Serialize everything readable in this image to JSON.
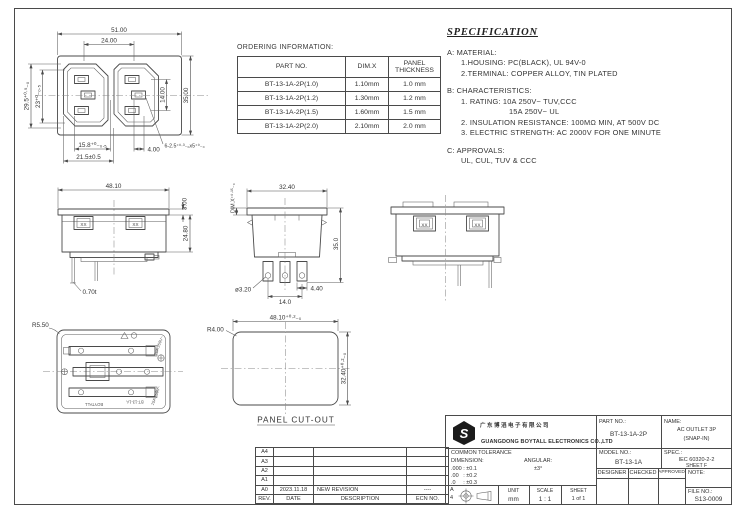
{
  "ordering": {
    "title": "ORDERING INFORMATION:",
    "col1": "PART NO.",
    "col2": "DIM.X",
    "col3": "PANEL\nTHICKNESS",
    "rows": [
      [
        "BT-13-1A-2P(1.0)",
        "1.10mm",
        "1.0 mm"
      ],
      [
        "BT-13-1A-2P(1.2)",
        "1.30mm",
        "1.2 mm"
      ],
      [
        "BT-13-1A-2P(1.5)",
        "1.60mm",
        "1.5 mm"
      ],
      [
        "BT-13-1A-2P(2.0)",
        "2.10mm",
        "2.0 mm"
      ]
    ]
  },
  "spec": {
    "title": "SPECIFICATION",
    "a_head": "A:  MATERIAL:",
    "a1": "1.HOUSING:  PC(BLACK), UL 94V-0",
    "a2": "2.TERMINAL:  COPPER ALLOY, TIN PLATED",
    "b_head": "B:  CHARACTERISTICS:",
    "b1": "1. RATING:  10A  250V~  TUV,CCC",
    "b2": "15A  250V~  UL",
    "b3": "2. INSULATION RESISTANCE:  100MΩ MIN, AT 500V DC",
    "b4": "3. ELECTRIC STRENGTH:  AC 2000V FOR ONE MINUTE",
    "c_head": "C:  APPROVALS:",
    "c1": "UL, CUL, TUV & CCC"
  },
  "front": {
    "w": "51.00",
    "iw": "24.00",
    "hl": "29.5⁺⁰·⁵₋₀",
    "hl2": "23⁺⁰₋₀.₅",
    "hr": "14.00",
    "hr2": "35.00",
    "b1": "15.8⁺⁰₋₀.₅",
    "b2": "21.5±0.5",
    "b3": "4.00",
    "note": "6-2.5⁺⁰·³₋₀x5⁺⁰₋₀"
  },
  "sideA": {
    "w": "48.10",
    "flange": "3.00",
    "h": "24.80",
    "t": "0.70t",
    "xx": "XX"
  },
  "sideB": {
    "w": "32.40",
    "dimx": "DIM.X⁺⁰·¹⁵₋₀",
    "h": "35.0",
    "pin": "ø3.20",
    "pitch": "14.0",
    "pw": "4.40"
  },
  "rear": {
    "xx": "XX"
  },
  "back": {
    "r": "R5.50",
    "brand": "BOYTALL",
    "model": "BT-13-1A",
    "rate1": "10A 250V~",
    "rate2": "15A 250V~"
  },
  "cutout": {
    "r": "R4.00",
    "w": "48.10⁺⁰·²₋₀",
    "h": "32.40⁺⁰·²₋₀",
    "label": "PANEL CUT-OUT"
  },
  "title_block": {
    "company_cn": "广东博滔电子有限公司",
    "company_en": "GUANGDONG BOYTALL ELECTRONICS CO.,LTD",
    "part_label": "PART NO.:",
    "part_no": "BT-13-1A-2P",
    "name_label": "NAME:",
    "name1": "AC OUTLET 3P",
    "name2": "(SNAP-IN)",
    "model_label": "MODEL NO.:",
    "model_no": "BT-13-1A",
    "spec_label": "SPEC.:",
    "spec1": "IEC 60320-2-2",
    "spec2": "SHEET F",
    "designer": "DESIGNER",
    "checked": "CHECKED",
    "approved": "APPROVED",
    "note_label": "NOTE:",
    "tol_title": "COMMON TOLERANCE",
    "dim_label": "DIMENSION:",
    "ang_label": "ANGULAR:",
    "tol1": ".000 : ±0.1",
    "tol2": ".00   : ±0.2",
    "tol3": ".0     : ±0.3",
    "ang_val": "±3°",
    "size1": "A",
    "size2": "4",
    "unit_label": "UNIT",
    "unit": "mm",
    "scale_label": "SCALE",
    "scale": "1 : 1",
    "sheet_label": "SHEET",
    "sheet": "1 of 1",
    "file_label": "FILE NO.:",
    "file_no": "S13-0009"
  },
  "revisions": {
    "rows": [
      [
        "A4",
        "",
        "",
        ""
      ],
      [
        "A3",
        "",
        "",
        ""
      ],
      [
        "A2",
        "",
        "",
        ""
      ],
      [
        "A1",
        "",
        "",
        ""
      ],
      [
        "A0",
        "2023.11.18",
        "NEW REVISION",
        "----"
      ]
    ],
    "footer": [
      "REV.",
      "DATE",
      "DESCRIPTION",
      "ECN NO."
    ]
  }
}
